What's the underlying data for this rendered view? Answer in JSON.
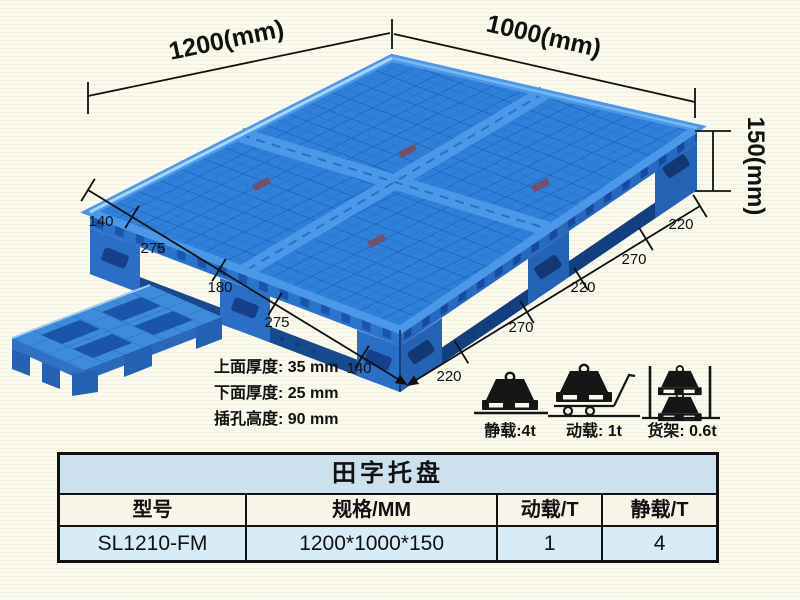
{
  "illustration": {
    "dimensions": {
      "length": "1200(mm)",
      "width": "1000(mm)",
      "height": "150(mm)",
      "left_chain": [
        "140",
        "275",
        "180",
        "275",
        "140"
      ],
      "right_chain": [
        "220",
        "270",
        "220",
        "270",
        "220"
      ]
    },
    "thickness_notes": [
      "上面厚度: 35 mm",
      "下面厚度: 25 mm",
      "插孔高度: 90 mm"
    ],
    "load_ratings": [
      {
        "icon": "static-load-icon",
        "label": "静载:4t"
      },
      {
        "icon": "dynamic-load-icon",
        "label": "动载: 1t"
      },
      {
        "icon": "rack-load-icon",
        "label": "货架: 0.6t"
      }
    ]
  },
  "table": {
    "title": "田字托盘",
    "headers": [
      "型号",
      "规格/MM",
      "动载/T",
      "静载/T"
    ],
    "rows": [
      [
        "SL1210-FM",
        "1200*1000*150",
        "1",
        "4"
      ]
    ]
  },
  "colors": {
    "pallet_blue": "#2e80d9",
    "pallet_dark_blue": "#1c5ebc",
    "annotation": "#111111",
    "table_title_bg": "#cde0ee",
    "table_header_bg": "#f8f4e8",
    "table_row_bg": "#d8ecf8",
    "background": "#fbfaef"
  }
}
